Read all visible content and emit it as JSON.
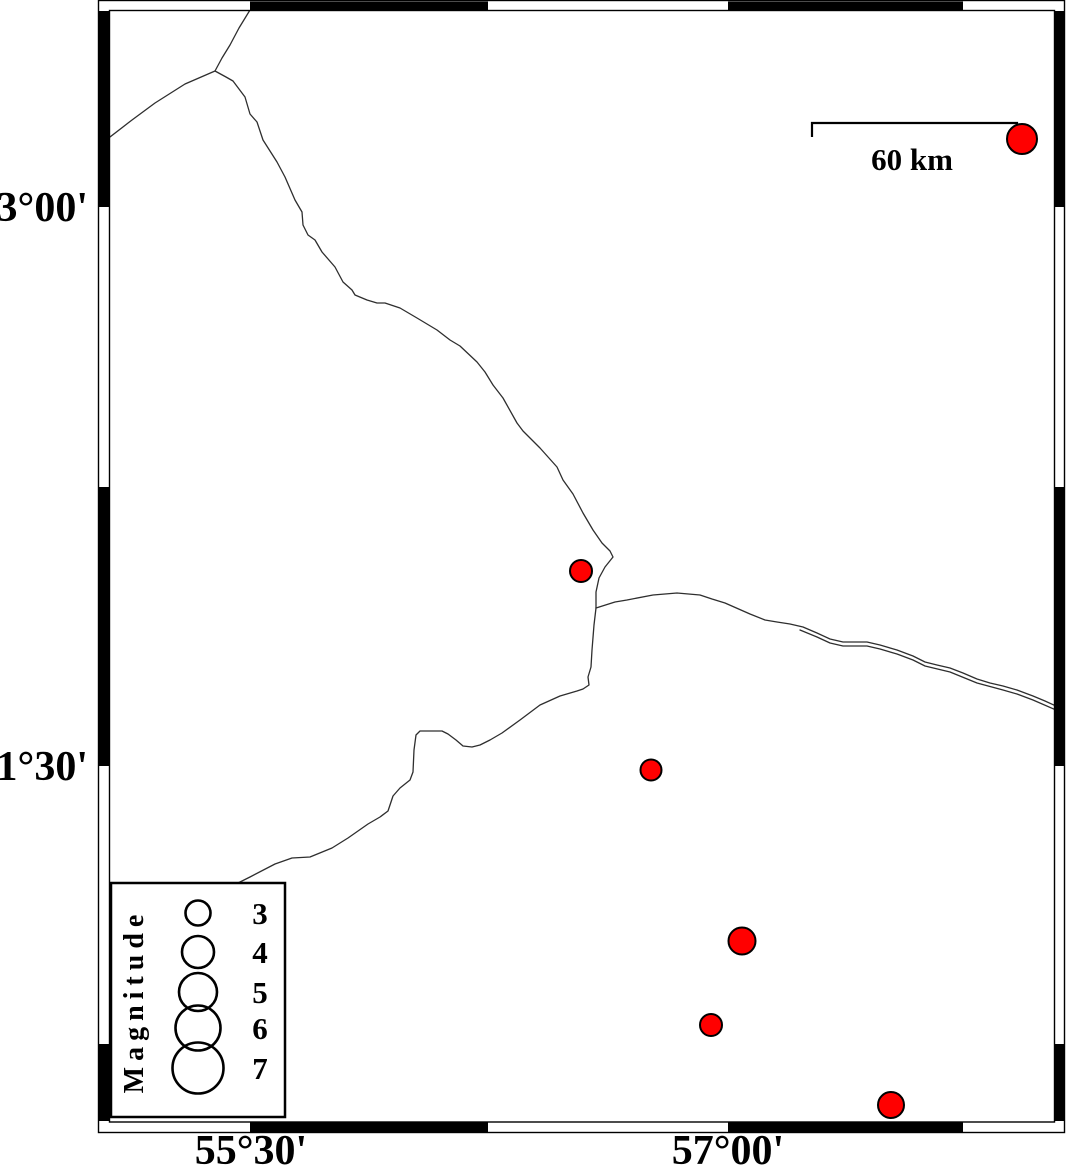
{
  "map": {
    "background_color": "#ffffff",
    "frame": {
      "stroke_color": "#000000",
      "black_color": "#000000",
      "white_color": "#ffffff",
      "outer": {
        "x": 98.5,
        "y": 0.5,
        "w": 966,
        "h": 1132
      },
      "inner": {
        "x": 109.5,
        "y": 10.5,
        "w": 945,
        "h": 1111.5
      },
      "top_band": {
        "y": 1.5,
        "h": 9
      },
      "bottom_band": {
        "y": 1122.5,
        "h": 9.5
      },
      "left_band": {
        "x": 99,
        "w": 10
      },
      "right_band": {
        "x": 1055,
        "w": 9
      },
      "horizontal_segments": [
        {
          "from": 110,
          "to": 250,
          "fill": "white"
        },
        {
          "from": 250,
          "to": 488,
          "fill": "black"
        },
        {
          "from": 488,
          "to": 728,
          "fill": "white"
        },
        {
          "from": 728,
          "to": 963,
          "fill": "black"
        },
        {
          "from": 963,
          "to": 1054,
          "fill": "white"
        }
      ],
      "vertical_segments": [
        {
          "from": 11,
          "to": 207,
          "fill": "black"
        },
        {
          "from": 207,
          "to": 487,
          "fill": "white"
        },
        {
          "from": 487,
          "to": 766,
          "fill": "black"
        },
        {
          "from": 766,
          "to": 1044,
          "fill": "white"
        },
        {
          "from": 1044,
          "to": 1121,
          "fill": "black"
        }
      ]
    },
    "annotations": {
      "left": [
        {
          "text": "33°00'",
          "x": 88,
          "y": 221
        },
        {
          "text": "31°30'",
          "x": 88,
          "y": 780
        }
      ],
      "bottom": [
        {
          "text": "55°30'",
          "x": 251,
          "y": 1164
        },
        {
          "text": "57°00'",
          "x": 728,
          "y": 1164
        }
      ]
    },
    "scalebar": {
      "label": "60 km",
      "label_x": 912,
      "label_y": 170,
      "bar_y": 123,
      "x1": 812,
      "x2": 1017,
      "tick_left_drop": 14,
      "tick_right_drop": 9,
      "stroke_width": 2.2
    },
    "faults": {
      "stroke_color": "#2e2e2e",
      "stroke_width": 1.3,
      "lines": [
        {
          "name": "fault-north-main",
          "points": [
            [
              250,
              10
            ],
            [
              239,
              28
            ],
            [
              230,
              45
            ],
            [
              222,
              58
            ],
            [
              215,
              71
            ],
            [
              226,
              77
            ],
            [
              233,
              81
            ],
            [
              245,
              97
            ],
            [
              250,
              114
            ],
            [
              257,
              122
            ],
            [
              263,
              140
            ],
            [
              270,
              151
            ],
            [
              277,
              162
            ],
            [
              285,
              177
            ],
            [
              295,
              200
            ],
            [
              302,
              212
            ],
            [
              303,
              225
            ],
            [
              308,
              235
            ],
            [
              315,
              240
            ],
            [
              322,
              252
            ],
            [
              335,
              267
            ],
            [
              343,
              282
            ],
            [
              352,
              290
            ],
            [
              355,
              295
            ],
            [
              367,
              300
            ],
            [
              377,
              303
            ],
            [
              385,
              303
            ],
            [
              400,
              308
            ],
            [
              417,
              318
            ],
            [
              437,
              330
            ],
            [
              450,
              340
            ],
            [
              460,
              346
            ],
            [
              477,
              362
            ],
            [
              485,
              372
            ],
            [
              493,
              385
            ],
            [
              503,
              398
            ],
            [
              517,
              423
            ],
            [
              523,
              431
            ],
            [
              540,
              448
            ],
            [
              557,
              467
            ],
            [
              563,
              480
            ],
            [
              573,
              494
            ],
            [
              583,
              513
            ],
            [
              593,
              530
            ],
            [
              602,
              543
            ],
            [
              610,
              551
            ],
            [
              613,
              557
            ],
            [
              605,
              567
            ],
            [
              599,
              578
            ],
            [
              596,
              592
            ],
            [
              596,
              608
            ]
          ]
        },
        {
          "name": "fault-northwest-branch",
          "points": [
            [
              215,
              71
            ],
            [
              185,
              84
            ],
            [
              155,
              103
            ],
            [
              132,
              120
            ],
            [
              110,
              137
            ]
          ]
        },
        {
          "name": "fault-east-road-upper",
          "points": [
            [
              596,
              608
            ],
            [
              615,
              602
            ],
            [
              627,
              600
            ],
            [
              653,
              595
            ],
            [
              677,
              593
            ],
            [
              700,
              595
            ],
            [
              712,
              599
            ],
            [
              725,
              603
            ],
            [
              750,
              614
            ],
            [
              765,
              620
            ],
            [
              777,
              622
            ],
            [
              790,
              624
            ],
            [
              803,
              627
            ],
            [
              817,
              633
            ],
            [
              830,
              639
            ],
            [
              843,
              642
            ],
            [
              855,
              642
            ],
            [
              867,
              642
            ],
            [
              880,
              645
            ],
            [
              897,
              650
            ],
            [
              913,
              656
            ],
            [
              925,
              662
            ],
            [
              937,
              665
            ],
            [
              950,
              668
            ],
            [
              963,
              673
            ],
            [
              977,
              679
            ],
            [
              990,
              683
            ],
            [
              1003,
              686
            ],
            [
              1017,
              690
            ],
            [
              1033,
              696
            ],
            [
              1045,
              701
            ],
            [
              1056,
              706
            ]
          ]
        },
        {
          "name": "fault-east-road-lower",
          "points": [
            [
              800,
              630
            ],
            [
              817,
              637
            ],
            [
              830,
              643
            ],
            [
              843,
              646
            ],
            [
              867,
              646
            ],
            [
              880,
              649
            ],
            [
              897,
              654
            ],
            [
              913,
              660
            ],
            [
              925,
              666
            ],
            [
              950,
              672
            ],
            [
              977,
              683
            ],
            [
              1003,
              690
            ],
            [
              1017,
              694
            ],
            [
              1033,
              700
            ],
            [
              1056,
              710
            ]
          ]
        },
        {
          "name": "fault-southwest-main",
          "points": [
            [
              596,
              608
            ],
            [
              594,
              625
            ],
            [
              592,
              650
            ],
            [
              591,
              667
            ],
            [
              588,
              677
            ],
            [
              589,
              685
            ],
            [
              583,
              689
            ],
            [
              577,
              691
            ],
            [
              560,
              696
            ],
            [
              540,
              705
            ],
            [
              520,
              720
            ],
            [
              502,
              733
            ],
            [
              490,
              740
            ],
            [
              480,
              745
            ],
            [
              472,
              747
            ],
            [
              463,
              746
            ],
            [
              456,
              740
            ],
            [
              448,
              734
            ],
            [
              442,
              731
            ],
            [
              430,
              731
            ],
            [
              420,
              731
            ],
            [
              416,
              735
            ],
            [
              414,
              750
            ],
            [
              413,
              772
            ],
            [
              410,
              780
            ],
            [
              400,
              788
            ],
            [
              393,
              796
            ],
            [
              390,
              805
            ],
            [
              388,
              811
            ],
            [
              380,
              817
            ],
            [
              368,
              824
            ],
            [
              348,
              838
            ],
            [
              332,
              848
            ],
            [
              310,
              857
            ],
            [
              292,
              858
            ],
            [
              275,
              864
            ],
            [
              250,
              877
            ],
            [
              238,
              883
            ]
          ]
        }
      ]
    },
    "earthquakes": {
      "fill_color": "#ff0000",
      "stroke_color": "#000000",
      "stroke_width": 2,
      "events": [
        {
          "x": 1022,
          "y": 139,
          "r": 15
        },
        {
          "x": 581,
          "y": 571,
          "r": 11
        },
        {
          "x": 651,
          "y": 770,
          "r": 10.5
        },
        {
          "x": 742,
          "y": 941,
          "r": 13.5
        },
        {
          "x": 711,
          "y": 1025,
          "r": 11
        },
        {
          "x": 891,
          "y": 1105,
          "r": 13
        }
      ]
    },
    "legend": {
      "title": "Magnitude",
      "box": {
        "x": 111,
        "y": 883,
        "w": 174,
        "h": 234,
        "stroke_width": 2.5
      },
      "title_cx": 143,
      "title_cy": 1001,
      "circle_cx": 198,
      "label_cx": 260,
      "circle_stroke_width": 2.6,
      "entries": [
        {
          "label": "3",
          "cy": 913,
          "r": 12.5
        },
        {
          "label": "4",
          "cy": 952,
          "r": 16
        },
        {
          "label": "5",
          "cy": 992,
          "r": 19
        },
        {
          "label": "6",
          "cy": 1028,
          "r": 22.5
        },
        {
          "label": "7",
          "cy": 1068,
          "r": 25.5
        }
      ]
    }
  }
}
